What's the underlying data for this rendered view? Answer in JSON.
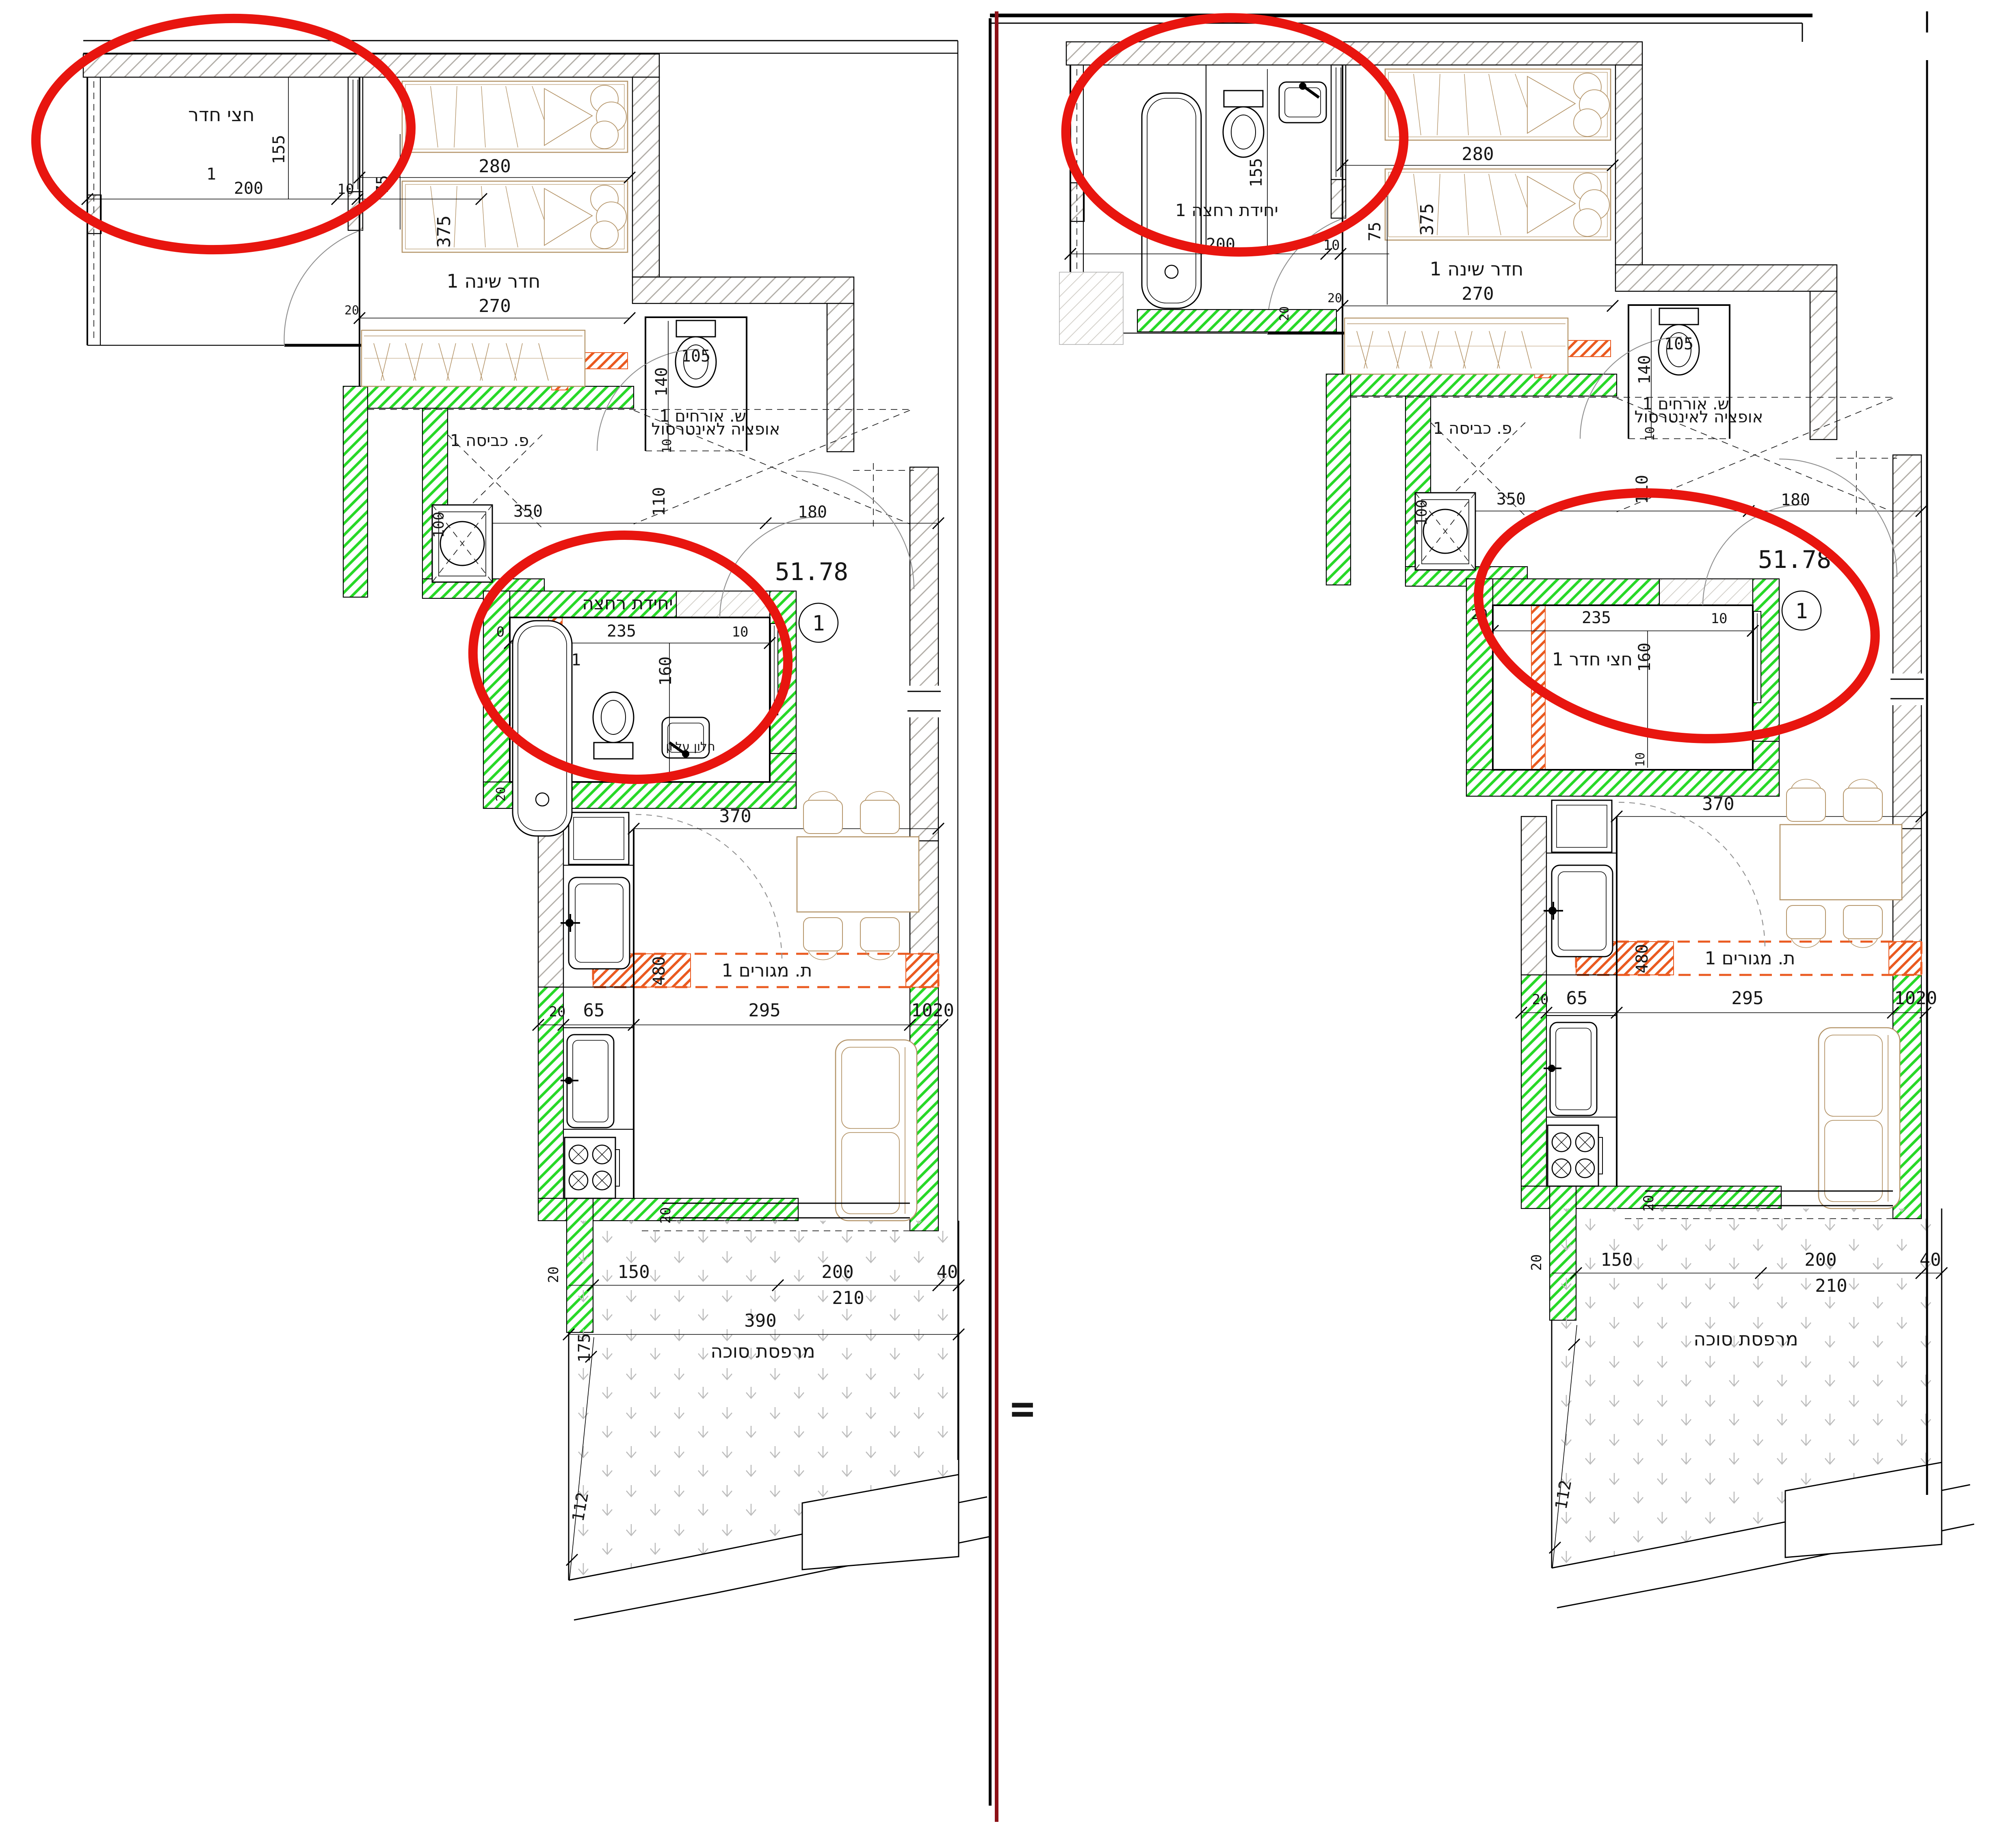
{
  "divider": {
    "equals": "="
  },
  "left": {
    "half_room": {
      "label": "חצי חדר",
      "num": "1",
      "w": "200",
      "h": "155",
      "d10": "10",
      "d75": "75"
    },
    "bedroom": {
      "label": "חדר שינה 1",
      "w": "280",
      "h": "375",
      "w2": "270",
      "d20": "20"
    },
    "wc": {
      "label": "ש. אורחים 1",
      "d105": "105",
      "d140": "140",
      "d10": "10"
    },
    "laundry": {
      "label": "פ. כביסה 1",
      "d100": "100"
    },
    "hall": {
      "note": "אופציה לאינטרסול",
      "d350": "350",
      "d110": "110",
      "d180": "180"
    },
    "bath": {
      "label": "יחידת רחצה",
      "num": "1",
      "w": "235",
      "h": "160",
      "d0": "0",
      "d10": "10",
      "d20": "20",
      "win": "חלון עליון"
    },
    "area": {
      "value": "51.78",
      "unit": "1"
    },
    "dining": {
      "d370": "370"
    },
    "living": {
      "label": "ת. מגורים 1",
      "d480": "480",
      "d65": "65",
      "d295": "295",
      "d1020": "1020",
      "d20": "20"
    },
    "kitchen": {
      "d20": "20"
    },
    "balcony": {
      "label": "מרפסת סוכה",
      "d150": "150",
      "d200": "200",
      "d210": "210",
      "d390": "390",
      "d40": "40",
      "d175": "175",
      "d112": "112",
      "d20": "20"
    }
  },
  "right": {
    "bath_top": {
      "label": "יחידת רחצה 1",
      "w": "200",
      "h": "155",
      "d10": "10",
      "d75": "75",
      "d20": "20"
    },
    "bedroom": {
      "label": "חדר שינה 1",
      "w": "280",
      "h": "375",
      "w2": "270",
      "d20": "20"
    },
    "wc": {
      "label": "ש. אורחים 1",
      "d105": "105",
      "d140": "140",
      "d10": "10"
    },
    "laundry": {
      "label": "פ. כביסה 1",
      "d100": "100"
    },
    "hall": {
      "note": "אופציה לאינטרסול",
      "d350": "350",
      "d110": "110",
      "d180": "180"
    },
    "half_room": {
      "label": "חצי חדר 1",
      "w": "235",
      "h": "160",
      "d10": "10",
      "d10b": "10",
      "d20": "20"
    },
    "area": {
      "value": "51.78",
      "unit": "1"
    },
    "dining": {
      "d370": "370"
    },
    "living": {
      "label": "ת. מגורים 1",
      "d480": "480",
      "d65": "65",
      "d295": "295",
      "d1020": "1020",
      "d20": "20"
    },
    "kitchen": {
      "d20": "20"
    },
    "balcony": {
      "label": "מרפסת סוכה",
      "d150": "150",
      "d200": "200",
      "d210": "210",
      "d40": "40",
      "d112": "112",
      "d20": "20"
    }
  }
}
